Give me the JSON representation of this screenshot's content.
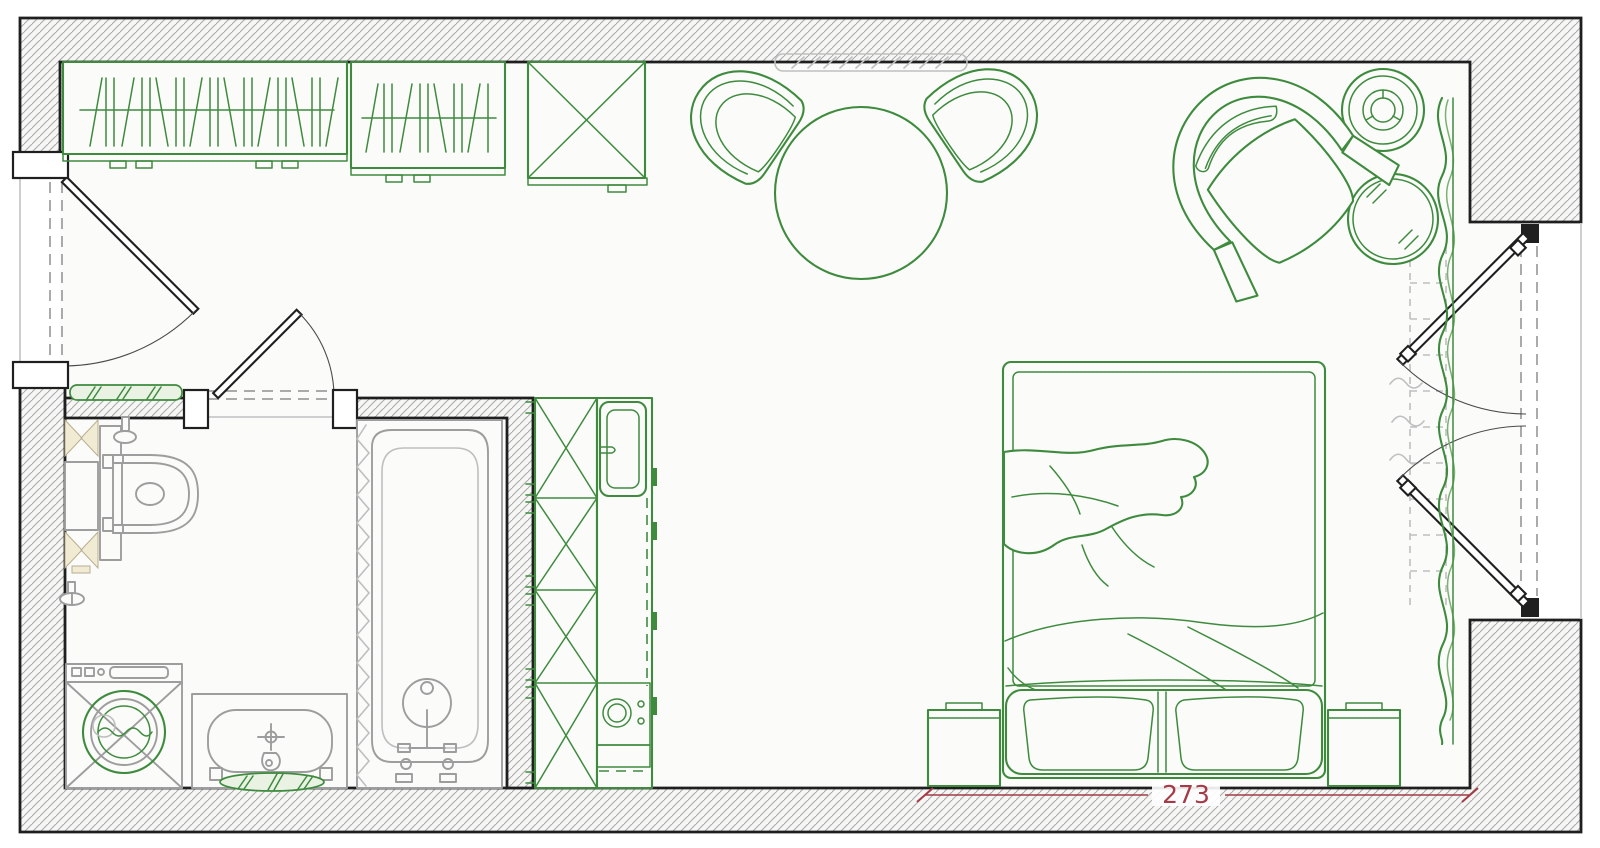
{
  "dimension": {
    "bed_width_label": "273"
  },
  "colors": {
    "wall_outline": "#1f1f1f",
    "wall_hatch": "#ababab",
    "wall_fill": "#f6f6f5",
    "floor": "#fbfbfa",
    "furniture_green": "#3e8b3e",
    "furniture_green_soft": "#79b26f",
    "fixture_gray": "#9d9d9d",
    "fixture_gray_light": "#bfbfbf",
    "accent_tan": "#f2ebd3",
    "tan_stroke": "#b7ae92",
    "mat_fill": "#e9f2e3",
    "dimension_red": "#a43b46",
    "swing_line": "#4a4a4a",
    "dash_gray": "#8f8f8f",
    "faint_gray": "#c9c9c9"
  }
}
